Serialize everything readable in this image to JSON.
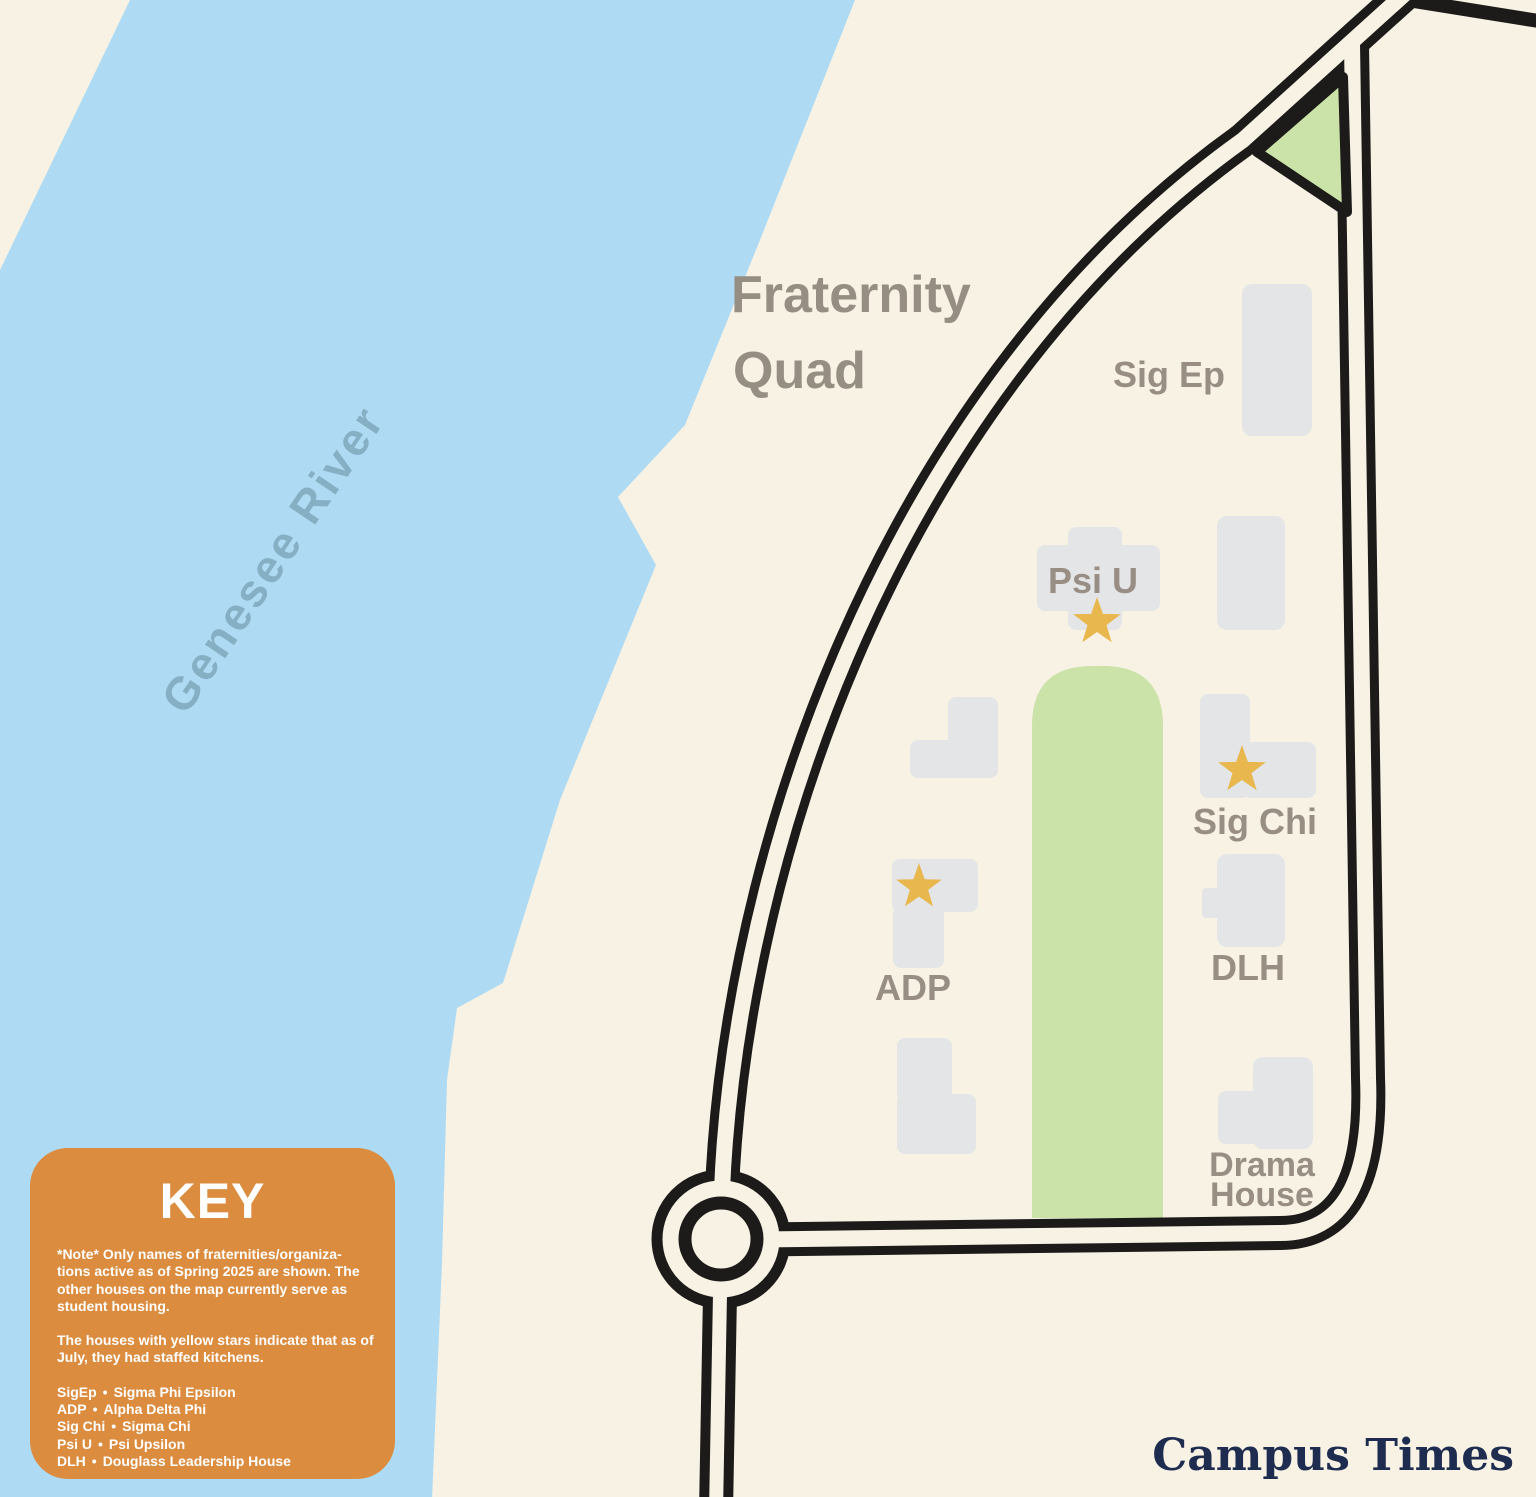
{
  "map": {
    "title_line1": "Fraternity",
    "title_line2": "Quad",
    "river_label": "Genesee River",
    "building_labels": {
      "sig_ep": "Sig Ep",
      "psi_u": "Psi U",
      "sig_chi": "Sig Chi",
      "adp": "ADP",
      "dlh": "DLH",
      "drama_line1": "Drama",
      "drama_line2": "House"
    },
    "colors": {
      "land": "#f7f2e4",
      "river": "#aedbf3",
      "lawn": "#cbe2a8",
      "building": "#e4e5e7",
      "road": "#1c1b19",
      "star": "#e8b74d",
      "label": "#978d83",
      "river_text": "#86afc4",
      "key_background": "#db8c3f",
      "brand_text": "#1e2c50"
    }
  },
  "key": {
    "title": "KEY",
    "note_lines": [
      "*Note* Only names of fraternities/organiza-",
      "tions active as of Spring 2025 are shown. The",
      "other houses on the map currently serve as",
      "student housing."
    ],
    "kitchen_lines": [
      "The houses with yellow stars indicate that as of",
      "July, they had staffed kitchens."
    ],
    "bullet": "•",
    "legend": [
      {
        "abbr": "SigEp",
        "full": "Sigma Phi Epsilon"
      },
      {
        "abbr": "ADP",
        "full": "Alpha Delta Phi"
      },
      {
        "abbr": "Sig Chi",
        "full": "Sigma Chi"
      },
      {
        "abbr": "Psi U",
        "full": "Psi Upsilon"
      },
      {
        "abbr": "DLH",
        "full": "Douglass Leadership House"
      }
    ]
  },
  "brand": {
    "name": "Campus Times"
  }
}
